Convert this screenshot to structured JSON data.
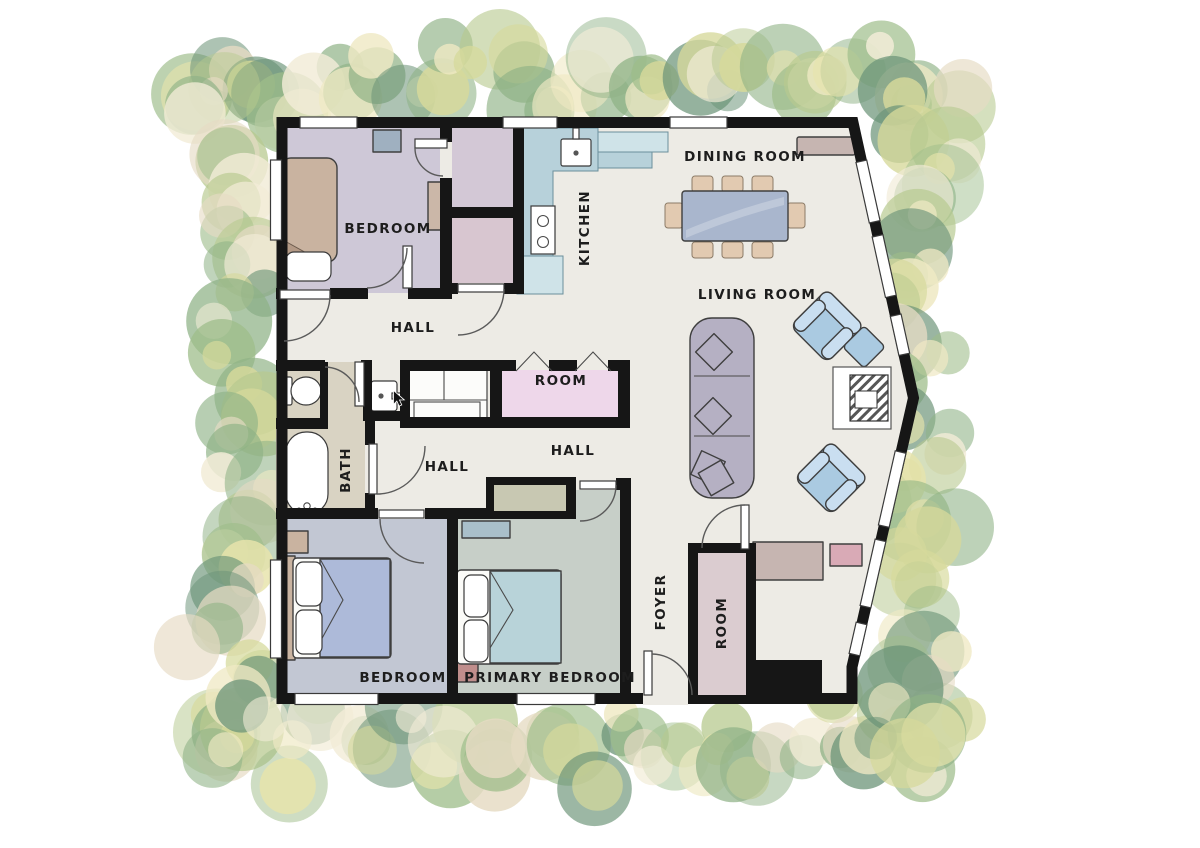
{
  "image_type": "residential floor plan drawing",
  "rooms": {
    "bedroom_top": {
      "label": "BEDROOM"
    },
    "kitchen": {
      "label": "KITCHEN"
    },
    "dining_room": {
      "label": "DINING ROOM"
    },
    "living_room": {
      "label": "LIVING ROOM"
    },
    "hall_upper": {
      "label": "HALL"
    },
    "hall_left": {
      "label": "HALL"
    },
    "hall_right": {
      "label": "HALL"
    },
    "room_middle": {
      "label": "ROOM"
    },
    "bath": {
      "label": "BATH"
    },
    "bedroom_bottom": {
      "label": "BEDROOM"
    },
    "primary_bedroom": {
      "label": "PRIMARY BEDROOM"
    },
    "foyer": {
      "label": "FOYER"
    },
    "room_bottom": {
      "label": "ROOM"
    }
  },
  "colors": {
    "wall": "#161616",
    "floor": "#edebe5",
    "bed1": "#cec8d7",
    "closet1": "#d3c8d6",
    "closet2": "#d8c6d0",
    "room_mid": "#eed7ea",
    "greige": "#d9d3c3",
    "bed2": "#c2c7d3",
    "primary": "#c7cfc8",
    "room_bottom": "#dbccd0",
    "olive": "#c8c8b2",
    "counter": "#b7d1da",
    "counter2": "#cfe3e8",
    "sofa": "#b5b0c3",
    "chair_blue": "#aacae1",
    "chair_blue_light": "#c9def0",
    "table_blue": "#a9b6cd",
    "chair_tan": "#e2cab1",
    "wood_tan": "#c9b3a0",
    "blanket_blue": "#adbad9",
    "blanket_teal": "#b8d3d9",
    "sideboard": "#c6b5b1",
    "pink_accent": "#d9aab6",
    "foliage_palette": [
      "#6c9478",
      "#8fb286",
      "#9ebd8a",
      "#b7c98f",
      "#d6d99b",
      "#e7e3ab",
      "#efe9c4",
      "#e6dbc4",
      "#f2ecd7"
    ]
  }
}
